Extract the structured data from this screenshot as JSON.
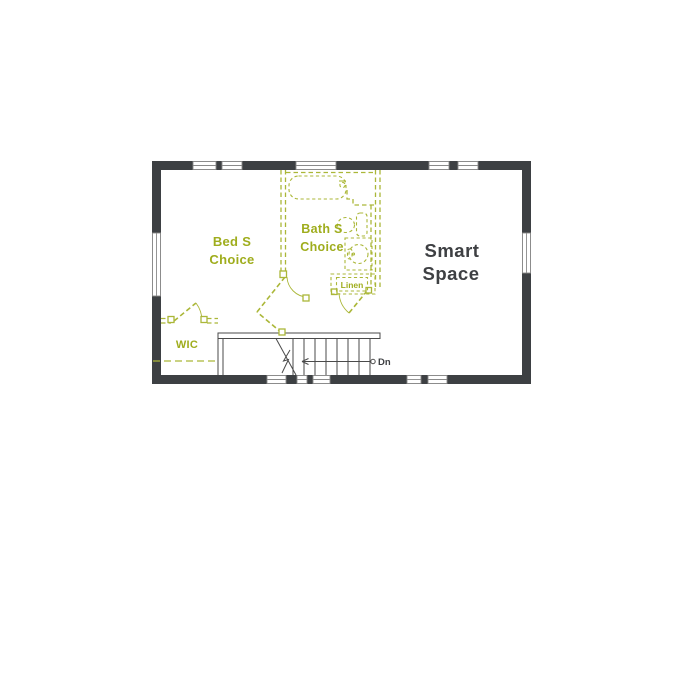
{
  "colors": {
    "wall_dark": "#3d4043",
    "window_gray": "#8a8a8a",
    "stair_gray": "#4a4a4a",
    "green_line": "#abb738",
    "green_text": "#9fad1d",
    "dark_text": "#3e4043",
    "background": "#ffffff"
  },
  "floorplan": {
    "rooms": {
      "bed_choice": {
        "line1": "Bed S",
        "line2": "Choice"
      },
      "bath_choice": {
        "line1": "Bath S",
        "line2": "Choice"
      },
      "smart_space": {
        "line1": "Smart",
        "line2": "Space"
      },
      "wic": {
        "label": "WIC"
      },
      "linen": {
        "label": "Linen"
      }
    },
    "stairs": {
      "down_label": "Dn"
    },
    "fixtures": [
      {
        "name": "bathtub"
      },
      {
        "name": "toilet"
      },
      {
        "name": "sink-vanity"
      }
    ]
  }
}
